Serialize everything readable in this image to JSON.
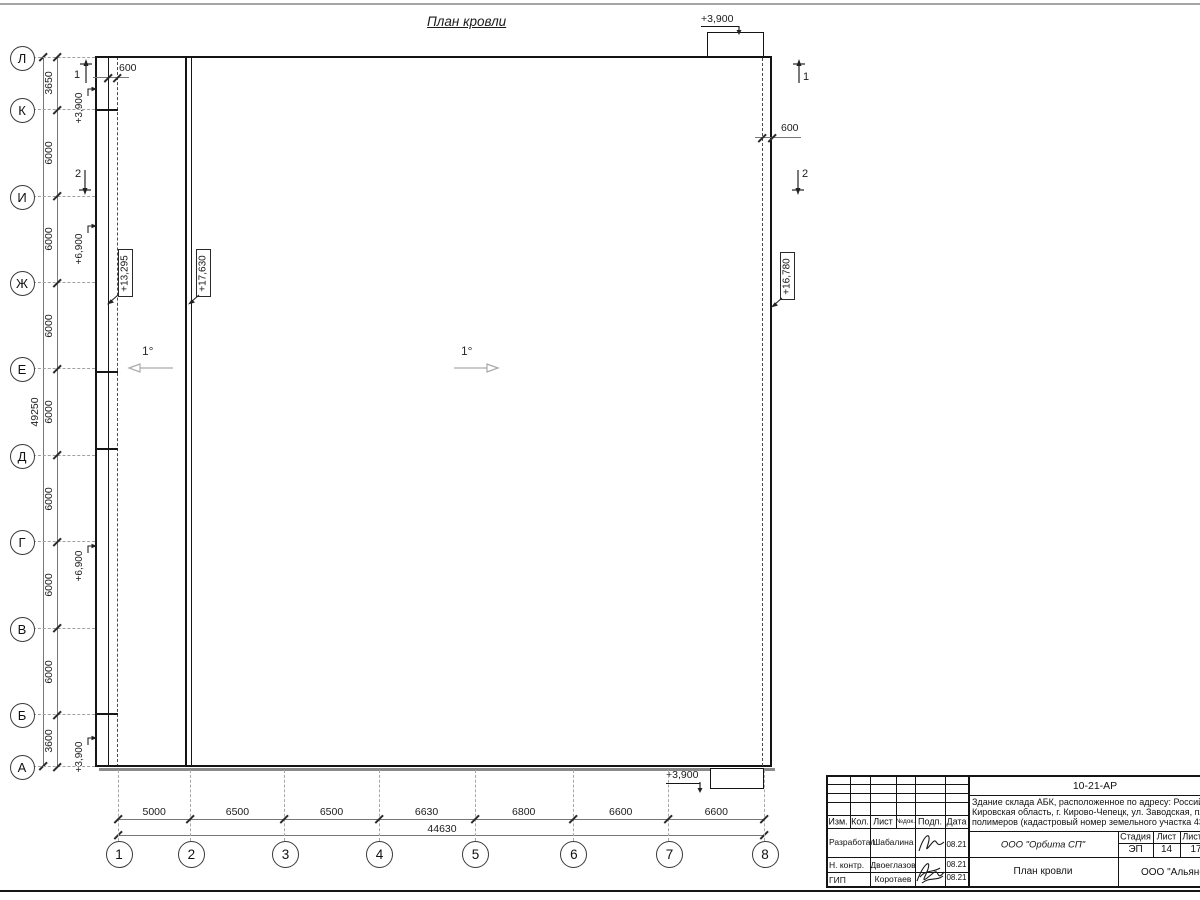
{
  "drawing": {
    "title": "План кровли",
    "slope_left": "1°",
    "slope_right": "1°"
  },
  "axes": {
    "row_labels": [
      "Л",
      "К",
      "И",
      "Ж",
      "Е",
      "Д",
      "Г",
      "В",
      "Б",
      "А"
    ],
    "row_mm": [
      0,
      3650,
      9650,
      15650,
      21650,
      27650,
      33650,
      39650,
      45650,
      49250
    ],
    "col_labels": [
      "1",
      "2",
      "3",
      "4",
      "5",
      "6",
      "7",
      "8"
    ],
    "col_mm": [
      0,
      5000,
      11500,
      18000,
      24630,
      31430,
      38030,
      44630
    ]
  },
  "dims": {
    "left_segments": [
      "3650",
      "6000",
      "6000",
      "6000",
      "6000",
      "6000",
      "6000",
      "6000",
      "3600"
    ],
    "left_total": "49250",
    "bottom_segments": [
      "5000",
      "6500",
      "6500",
      "6630",
      "6800",
      "6600",
      "6600"
    ],
    "bottom_total": "44630",
    "offset_top_left": "600",
    "offset_right": "600"
  },
  "elevations": {
    "wall_top_left": "+3,900",
    "wall_left_upper": "+6,900",
    "wall_left_lower": "+6,900",
    "wall_bottom_left": "+3,900",
    "roof_low": "+13,295",
    "roof_high": "+17,630",
    "roof_right": "+16,780",
    "canopy_top": "+3,900",
    "canopy_bottom": "+3,900"
  },
  "sections": {
    "s1": "1",
    "s2": "2"
  },
  "title_block": {
    "doc_number": "10-21-АР",
    "address_lines": [
      "Здание склада АБК, расположенное по адресу: Российская Феде",
      "Кировская область, г. Кирово-Чепецк, ул. Заводская, площадка з",
      "полимеров (кадастровый номер земельного участка 43:42:00000"
    ],
    "columns": [
      "Изм.",
      "Кол.",
      "Лист",
      "№док.",
      "Подп.",
      "Дата"
    ],
    "rows": [
      {
        "role": "Разработал",
        "name": "Шабалина",
        "date": "08.21"
      },
      {
        "role": "Н. контр.",
        "name": "Двоеглазов",
        "date": "08.21"
      },
      {
        "role": "ГИП",
        "name": "Коротаев",
        "date": "08.21"
      }
    ],
    "company": "ООО \"Орбита СП\"",
    "stage_headers": [
      "Стадия",
      "Лист",
      "Листов"
    ],
    "stage": "ЭП",
    "sheet": "14",
    "sheets": "17",
    "sheet_title": "План кровли",
    "firm": "ООО \"Альянс"
  }
}
